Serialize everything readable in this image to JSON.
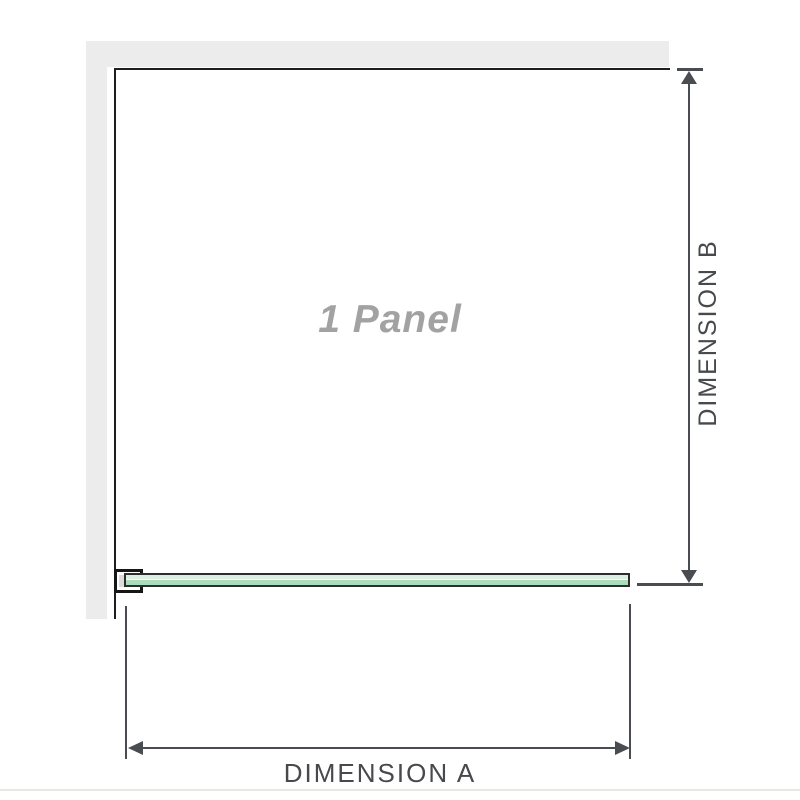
{
  "diagram": {
    "panel_label": "1 Panel",
    "dimensions": {
      "a_label": "DIMENSION A",
      "b_label": "DIMENSION B"
    },
    "icons": [
      "arrow-up-icon",
      "arrow-down-icon",
      "arrow-left-icon",
      "arrow-right-icon"
    ]
  },
  "colors": {
    "wall": "#ececec",
    "outline": "#1e1e1e",
    "dimension_line": "#494c50",
    "label_text": "#47494d",
    "panel_text": "#a2a2a2",
    "glass_border": "#2d2d2d",
    "glass_light": "#ddeee3",
    "glass_mid": "#f7fcf8",
    "glass_dark": "#abdcbc",
    "packing": "#dcdcdc",
    "divider": "#eae7e2"
  }
}
